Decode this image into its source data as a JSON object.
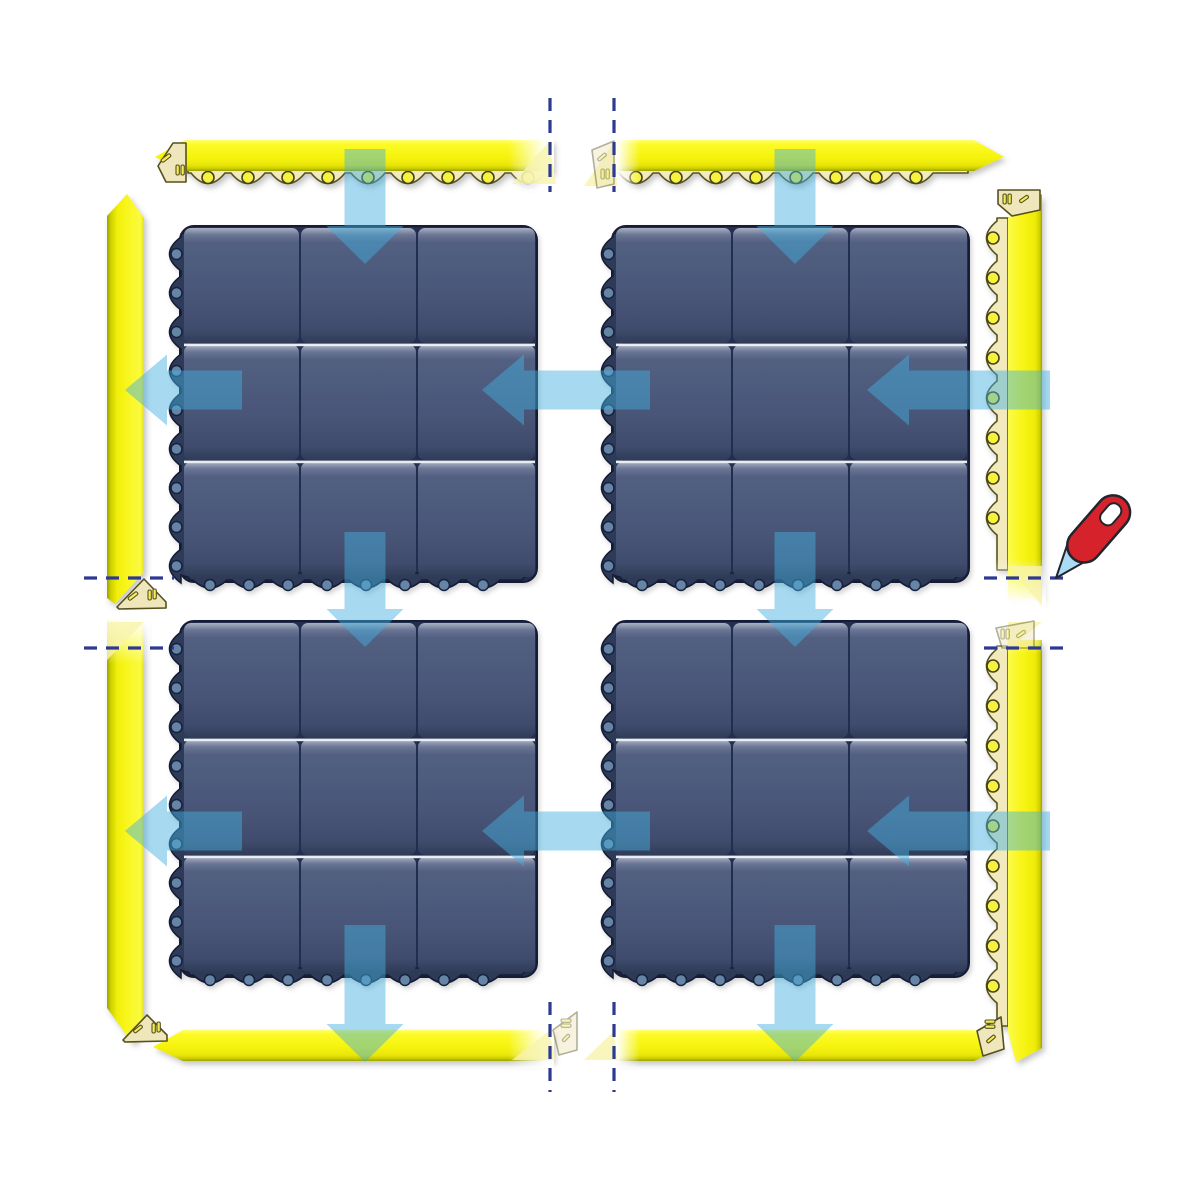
{
  "title": "modular-mat-assembly-diagram",
  "colors": {
    "background": "#ffffff",
    "mat_base": "#232f4d",
    "mat_edge": "#2d3b59",
    "mat_outline": "#141d36",
    "mat_hole": "#6684a6",
    "mat_hole_stroke": "#16203c",
    "tile_top": "#a9b1c3",
    "tile_light": "#6a7595",
    "tile_mid": "#4a577a",
    "tile_dark": "#404c6d",
    "tile_bottom": "#2f3b58",
    "divider_white": "#e8ecf3",
    "flap": "#f2e9bd",
    "flap_stroke": "#56521f",
    "flap_hole": "#f7f23c",
    "flap_hole_stroke": "#45421a",
    "wedge": "#f8f4ad",
    "cap": "#efe6bb",
    "cap_stroke": "#55511e",
    "cap_slot": "#f5ee56",
    "cap_slot_stroke": "#57521d",
    "arrow": "rgba(68,176,224,0.47)",
    "cutline": "#2e3a92",
    "knife_handle": "#d6232b",
    "knife_blade": "#a9dbf3",
    "knife_stroke": "#22252e",
    "knife_slot": "#ffffff"
  },
  "components": {
    "mat_spec": {
      "size": 365,
      "tiles_per_side": 3,
      "left_edge_holes": 9,
      "bottom_edge_holes": 8
    },
    "mats": [
      {
        "id": "mat-top-left",
        "x": 170,
        "y": 228
      },
      {
        "id": "mat-top-right",
        "x": 602,
        "y": 228
      },
      {
        "id": "mat-bottom-left",
        "x": 170,
        "y": 623
      },
      {
        "id": "mat-bottom-right",
        "x": 602,
        "y": 623
      }
    ],
    "ramps": [
      {
        "id": "ramp-top-left",
        "type": "h-top",
        "x1": 155,
        "x2": 553,
        "y": 140,
        "left": "point",
        "right": "cut"
      },
      {
        "id": "ramp-top-right",
        "type": "h-top",
        "x1": 614,
        "x2": 1004,
        "y": 140,
        "left": "cut",
        "right": "point"
      },
      {
        "id": "ramp-bottom-left",
        "type": "h-bottom",
        "x1": 153,
        "x2": 553,
        "y": 1030,
        "left": "point",
        "right": "cut"
      },
      {
        "id": "ramp-bottom-right",
        "type": "h-bottom",
        "x1": 614,
        "x2": 1004,
        "y": 1030,
        "left": "cut",
        "right": "point"
      },
      {
        "id": "ramp-left-upper",
        "type": "v-left",
        "x": 107,
        "y1": 194,
        "y2": 604,
        "top": "point",
        "bottom": "angle"
      },
      {
        "id": "ramp-left-lower",
        "type": "v-left",
        "x": 107,
        "y1": 620,
        "y2": 1044,
        "top": "cut",
        "bottom": "tip"
      },
      {
        "id": "ramp-right-upper",
        "type": "v-right",
        "x": 988,
        "y1": 192,
        "y2": 600,
        "top": "angle",
        "bottom": "cut"
      },
      {
        "id": "ramp-right-lower",
        "type": "v-right",
        "x": 988,
        "y1": 640,
        "y2": 1062,
        "top": "cut",
        "bottom": "tip"
      }
    ],
    "fades": [
      [
        508,
        134,
        46,
        58,
        "R"
      ],
      [
        612,
        134,
        28,
        58,
        "L"
      ],
      [
        508,
        1024,
        46,
        44,
        "R"
      ],
      [
        612,
        1024,
        28,
        44,
        "L"
      ],
      [
        100,
        612,
        50,
        52,
        "U"
      ],
      [
        980,
        558,
        66,
        54,
        "D"
      ],
      [
        980,
        614,
        66,
        40,
        "U"
      ]
    ],
    "wedges": [
      "512,184 549,142 556,184",
      "584,186 614,142 617,186",
      "512,1060 549,1031 556,1060",
      "584,1060 614,1031 617,1060",
      "107,622 144,622 107,660",
      "1008,566 1042,566 1042,606",
      "1008,622 1042,622 1008,650"
    ],
    "caps": [
      {
        "id": "corner-cap-top-left",
        "pts": "158,166 173,143 186,143 186,182 166,182",
        "slots": [
          [
            "r",
            166,
            158,
            11,
            3.4,
            -38
          ],
          [
            "v",
            176,
            165
          ],
          [
            "v",
            181,
            165
          ]
        ],
        "faded": false
      },
      {
        "id": "corner-cap-top-middle",
        "pts": "592,150 614,141 614,184 597,188",
        "slots": [
          [
            "r",
            602,
            157,
            10,
            3.2,
            -40
          ],
          [
            "v",
            601,
            169
          ],
          [
            "v",
            606,
            169
          ]
        ],
        "faded": true
      },
      {
        "id": "corner-cap-right-top",
        "pts": "998,190 1040,190 1040,210 1012,216 998,204",
        "slots": [
          [
            "v",
            1003,
            194
          ],
          [
            "v",
            1008,
            194
          ],
          [
            "r",
            1024,
            199,
            10,
            3.2,
            -35
          ]
        ],
        "faded": false
      },
      {
        "id": "corner-cap-right-middle",
        "pts": "996,628 1034,621 1034,648 1002,648",
        "slots": [
          [
            "v",
            1001,
            629
          ],
          [
            "v",
            1006,
            629
          ],
          [
            "r",
            1021,
            634,
            10,
            3.2,
            -35
          ]
        ],
        "faded": true
      },
      {
        "id": "corner-cap-left-middle",
        "pts": "117,607 144,579 166,602 166,608 119,609",
        "slots": [
          [
            "r",
            133,
            596,
            11,
            3.4,
            -38
          ],
          [
            "v",
            148,
            590
          ],
          [
            "v",
            153,
            589
          ]
        ],
        "faded": false
      },
      {
        "id": "corner-cap-bottom-left",
        "pts": "123,1040 147,1015 167,1035 167,1041 125,1042",
        "slots": [
          [
            "r",
            138,
            1029,
            10,
            3.2,
            -38
          ],
          [
            "v",
            152,
            1023
          ],
          [
            "v",
            157,
            1022
          ]
        ],
        "faded": false
      },
      {
        "id": "corner-cap-bottom-middle",
        "pts": "553,1030 577,1012 577,1050 559,1055",
        "slots": [
          [
            "h",
            561,
            1019
          ],
          [
            "h",
            561,
            1024
          ],
          [
            "r",
            566,
            1038,
            9,
            3,
            -45
          ]
        ],
        "faded": true
      },
      {
        "id": "corner-cap-bottom-right",
        "pts": "977,1031 1001,1017 1004,1049 983,1056",
        "slots": [
          [
            "h",
            985,
            1020
          ],
          [
            "h",
            985,
            1025
          ],
          [
            "r",
            991,
            1039,
            10,
            3.2,
            -40
          ]
        ],
        "faded": false
      }
    ],
    "cut_lines": [
      {
        "o": "v",
        "x": 550,
        "y1": 98,
        "y2": 192
      },
      {
        "o": "v",
        "x": 614,
        "y1": 98,
        "y2": 192
      },
      {
        "o": "v",
        "x": 550,
        "y1": 1002,
        "y2": 1092
      },
      {
        "o": "v",
        "x": 614,
        "y1": 1002,
        "y2": 1092
      },
      {
        "o": "h",
        "y": 578,
        "x1": 84,
        "x2": 174
      },
      {
        "o": "h",
        "y": 648,
        "x1": 84,
        "x2": 174
      },
      {
        "o": "h",
        "y": 578,
        "x1": 984,
        "x2": 1072
      },
      {
        "o": "h",
        "y": 648,
        "x1": 984,
        "x2": 1072
      }
    ],
    "arrows": [
      {
        "id": "arrow-down-top-left",
        "dir": "down",
        "c": 365,
        "from": 149,
        "tip": 264
      },
      {
        "id": "arrow-down-top-right",
        "dir": "down",
        "c": 795,
        "from": 149,
        "tip": 264
      },
      {
        "id": "arrow-down-mid-left",
        "dir": "down",
        "c": 365,
        "from": 532,
        "tip": 647
      },
      {
        "id": "arrow-down-mid-right",
        "dir": "down",
        "c": 795,
        "from": 532,
        "tip": 647
      },
      {
        "id": "arrow-down-bottom-left",
        "dir": "down",
        "c": 365,
        "from": 925,
        "tip": 1062
      },
      {
        "id": "arrow-down-bottom-right",
        "dir": "down",
        "c": 795,
        "from": 925,
        "tip": 1062
      },
      {
        "id": "arrow-left-outer-top",
        "dir": "left",
        "c": 390,
        "from": 242,
        "tip": 125
      },
      {
        "id": "arrow-left-middle-top",
        "dir": "left",
        "c": 390,
        "from": 650,
        "tip": 482
      },
      {
        "id": "arrow-left-inner-top",
        "dir": "left",
        "c": 390,
        "from": 1050,
        "tip": 867
      },
      {
        "id": "arrow-left-outer-bottom",
        "dir": "left",
        "c": 831,
        "from": 242,
        "tip": 125
      },
      {
        "id": "arrow-left-middle-bottom",
        "dir": "left",
        "c": 831,
        "from": 650,
        "tip": 482
      },
      {
        "id": "arrow-left-inner-bottom",
        "dir": "left",
        "c": 831,
        "from": 1050,
        "tip": 867
      }
    ],
    "knife": {
      "x": 1056,
      "y": 578,
      "angle": -49
    }
  }
}
